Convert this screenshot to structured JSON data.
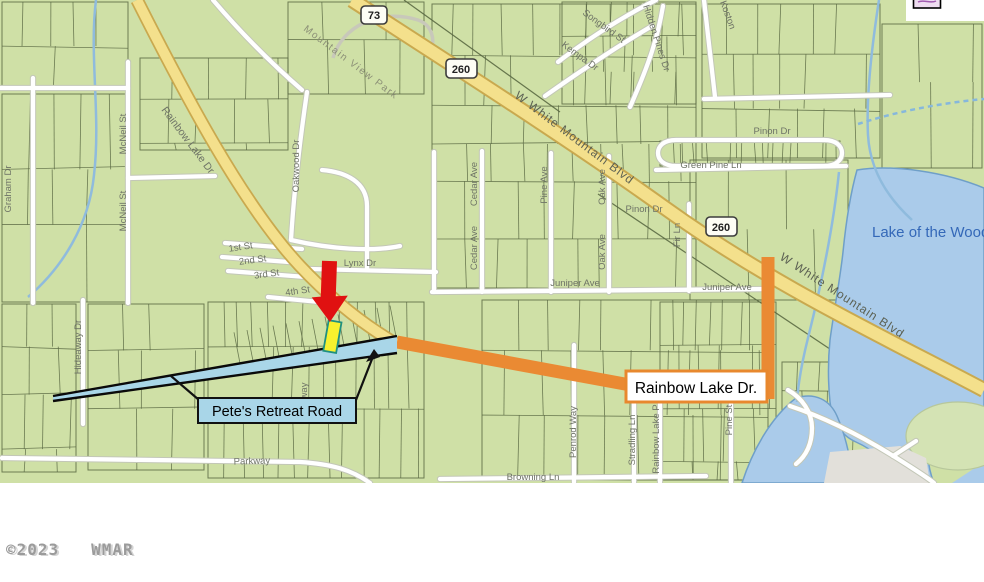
{
  "map": {
    "shields": {
      "hwy73": "73",
      "hwy260_a": "260",
      "hwy260_b": "260"
    },
    "streets": [
      {
        "name": "mountain-view-park",
        "text": "Mountain View Park"
      },
      {
        "name": "w-white-mountain-blvd-1",
        "text": "W White Mountain Blvd"
      },
      {
        "name": "w-white-mountain-blvd-2",
        "text": "W White Mountain Blvd"
      },
      {
        "name": "rainbow-lake-dr-nw",
        "text": "Rainbow Lake Dr"
      },
      {
        "name": "rainbow-lake-dr-e",
        "text": "Rainbow Lake Dr"
      },
      {
        "name": "songbird-st",
        "text": "Songbird St"
      },
      {
        "name": "hidden-pines-dr",
        "text": "Hidden Pines Dr"
      },
      {
        "name": "kempa-dr",
        "text": "Kempa Dr"
      },
      {
        "name": "koston",
        "text": "Koston"
      },
      {
        "name": "graham-dr",
        "text": "Graham Dr"
      },
      {
        "name": "mcneil-st-1",
        "text": "McNeil St"
      },
      {
        "name": "mcneil-st-2",
        "text": "McNeil St"
      },
      {
        "name": "oakwood-dr",
        "text": "Oakwood Dr"
      },
      {
        "name": "hideaway-dr",
        "text": "Hideaway Dr"
      },
      {
        "name": "cedar-ave-1",
        "text": "Cedar Ave"
      },
      {
        "name": "cedar-ave-2",
        "text": "Cedar Ave"
      },
      {
        "name": "pine-ave",
        "text": "Pine Ave"
      },
      {
        "name": "oak-ave-1",
        "text": "Oak Ave"
      },
      {
        "name": "oak-ave-2",
        "text": "Oak Ave"
      },
      {
        "name": "fir-ln",
        "text": "Fir Ln"
      },
      {
        "name": "pinon-dr-1",
        "text": "Pinon Dr"
      },
      {
        "name": "green-pine-ln",
        "text": "Green Pine Ln"
      },
      {
        "name": "pinon-dr-2",
        "text": "Pinon Dr"
      },
      {
        "name": "juniper-ave-1",
        "text": "Juniper Ave"
      },
      {
        "name": "juniper-ave-2",
        "text": "Juniper Ave"
      },
      {
        "name": "lynx-dr",
        "text": "Lynx Dr"
      },
      {
        "name": "first-st",
        "text": "1st St"
      },
      {
        "name": "second-st",
        "text": "2nd St"
      },
      {
        "name": "third-st",
        "text": "3rd St"
      },
      {
        "name": "fourth-st",
        "text": "4th St"
      },
      {
        "name": "parkway",
        "text": "Parkway"
      },
      {
        "name": "browning-ln",
        "text": "Browning Ln"
      },
      {
        "name": "penrod-way",
        "text": "Penrod Way"
      },
      {
        "name": "stradling-ln",
        "text": "Stradling Ln"
      },
      {
        "name": "rainbow-lake-p",
        "text": "Rainbow Lake P"
      },
      {
        "name": "pine-st",
        "text": "Pine St"
      },
      {
        "name": "way-fragment",
        "text": "way"
      }
    ],
    "water": {
      "lake_label": "Lake of the Woods"
    },
    "callouts": {
      "petes": "Pete's Retreat Road",
      "rainbow": "Rainbow Lake Dr."
    }
  },
  "footer": {
    "copyright": "©2023   WMAR"
  }
}
